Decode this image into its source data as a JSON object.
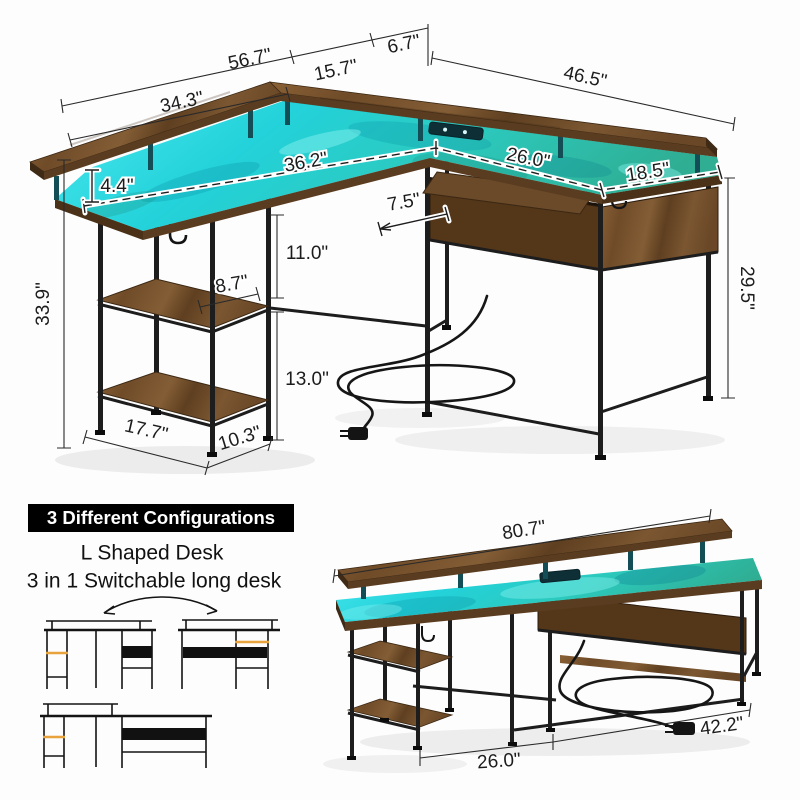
{
  "main_diagram": {
    "dimensions": {
      "top_total": "56.7\"",
      "top_middle": "15.7\"",
      "top_corner": "6.7\"",
      "monitor_shelf": "34.3\"",
      "right_side_top": "46.5\"",
      "desktop_long": "36.2\"",
      "desktop_right": "26.0\"",
      "desktop_depth": "18.5\"",
      "riser_height": "4.4\"",
      "tray_depth": "7.5\"",
      "upper_shelf_gap": "11.0\"",
      "shelf_depth": "8.7\"",
      "lower_shelf_gap": "13.0\"",
      "overall_height": "33.9\"",
      "desk_height": "29.5\"",
      "tower_width": "17.7\"",
      "tower_depth": "10.3\""
    }
  },
  "configurations": {
    "badge": "3 Different Configurations",
    "line1": "L Shaped Desk",
    "line2": "3 in 1 Switchable long desk"
  },
  "long_desk_diagram": {
    "dimensions": {
      "total_length": "80.7\"",
      "left_section": "26.0\"",
      "right_section": "42.2\""
    }
  },
  "colors": {
    "led_glow": "#2ad8e0",
    "wood": "#7a5531",
    "metal_frame": "#1d1d1d",
    "badge_background": "#000000",
    "badge_text": "#ffffff",
    "accent_orange": "#e8a33d",
    "dimension_text": "#1c1c1c"
  }
}
